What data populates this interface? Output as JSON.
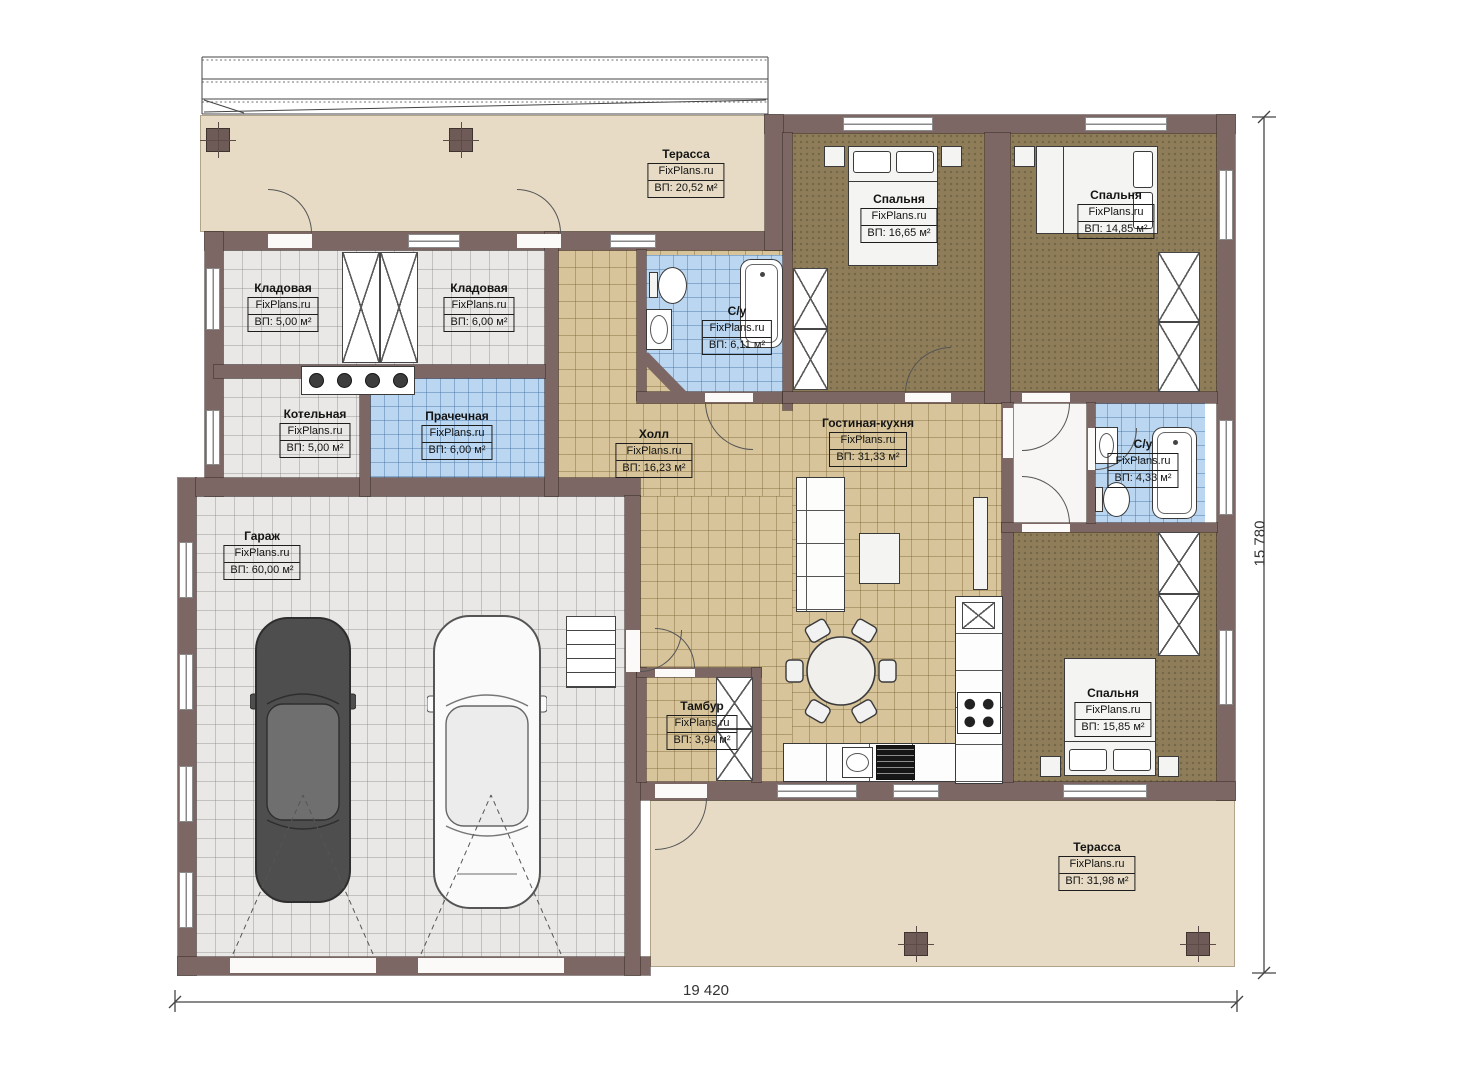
{
  "plan": {
    "brand": "FixPlans.ru",
    "dimensions": {
      "width": "19 420",
      "height": "15 780"
    },
    "rooms": {
      "terrace_top": {
        "name": "Терасса",
        "brand": "FixPlans.ru",
        "area": "ВП: 20,52 м²"
      },
      "bedroom_1": {
        "name": "Спальня",
        "brand": "FixPlans.ru",
        "area": "ВП: 16,65 м²"
      },
      "bedroom_2": {
        "name": "Спальня",
        "brand": "FixPlans.ru",
        "area": "ВП: 14,85 м²"
      },
      "storage_1": {
        "name": "Кладовая",
        "brand": "FixPlans.ru",
        "area": "ВП: 5,00 м²"
      },
      "storage_2": {
        "name": "Кладовая",
        "brand": "FixPlans.ru",
        "area": "ВП: 6,00 м²"
      },
      "bathroom_1": {
        "name": "С/у",
        "brand": "FixPlans.ru",
        "area": "ВП: 6,11 м²"
      },
      "boiler_room": {
        "name": "Котельная",
        "brand": "FixPlans.ru",
        "area": "ВП: 5,00 м²"
      },
      "laundry": {
        "name": "Прачечная",
        "brand": "FixPlans.ru",
        "area": "ВП: 6,00 м²"
      },
      "hall": {
        "name": "Холл",
        "brand": "FixPlans.ru",
        "area": "ВП: 16,23 м²"
      },
      "living_kitchen": {
        "name": "Гостиная-кухня",
        "brand": "FixPlans.ru",
        "area": "ВП: 31,33 м²"
      },
      "bathroom_2": {
        "name": "С/у",
        "brand": "FixPlans.ru",
        "area": "ВП: 4,33 м²"
      },
      "garage": {
        "name": "Гараж",
        "brand": "FixPlans.ru",
        "area": "ВП: 60,00 м²"
      },
      "vestibule": {
        "name": "Тамбур",
        "brand": "FixPlans.ru",
        "area": "ВП: 3,94 м²"
      },
      "bedroom_3": {
        "name": "Спальня",
        "brand": "FixPlans.ru",
        "area": "ВП: 15,85 м²"
      },
      "terrace_bottom": {
        "name": "Терасса",
        "brand": "FixPlans.ru",
        "area": "ВП: 31,98 м²"
      }
    },
    "colors": {
      "wall": "#7d6765",
      "terrace_floor": "#e7dbc5",
      "bedroom_floor": "#8e7d58",
      "hall_floor": "#d7c49a",
      "garage_floor": "#e9e8e6",
      "bathroom_floor": "#bad6f0"
    }
  }
}
